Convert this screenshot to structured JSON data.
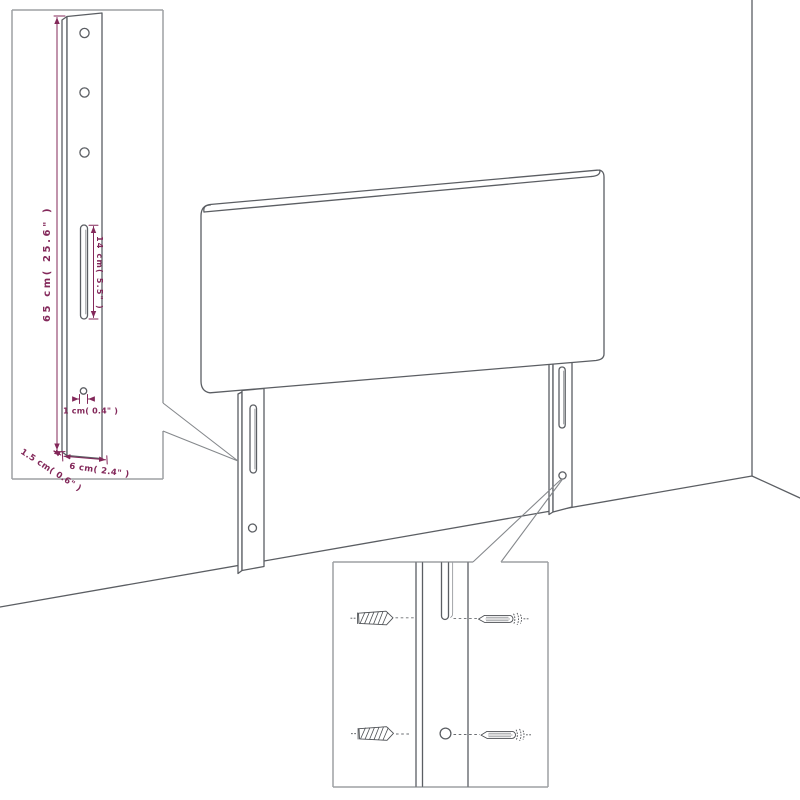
{
  "diagram": {
    "colors": {
      "line": "#5b5e63",
      "inset_box": "#9da0a4",
      "dimension": "#83285a"
    },
    "leg_detail_inset": {
      "labels": {
        "leg_height": "65 cm( 25.6\" )",
        "slot_length": "14 cm( 5.5\" )",
        "hole_diameter": "1 cm( 0.4\" )",
        "leg_depth": "1.5 cm( 0.6\" )",
        "leg_width": "6 cm( 2.4\" )"
      }
    }
  }
}
